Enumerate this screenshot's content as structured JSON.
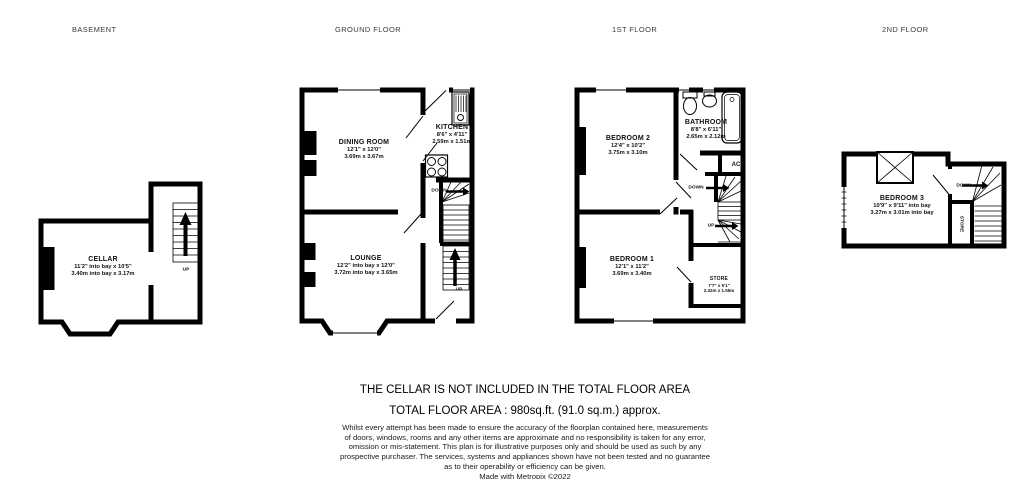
{
  "floors": {
    "basement": {
      "title": "BASEMENT",
      "cellar_name": "CELLAR",
      "cellar_dims": "11'2\" into bay x 10'5\"",
      "cellar_metric": "3.40m into bay x 3.17m",
      "up": "UP"
    },
    "ground": {
      "title": "GROUND FLOOR",
      "dining_name": "DINING ROOM",
      "dining_dims": "12'1\" x 12'0\"",
      "dining_metric": "3.69m x 3.67m",
      "kitchen_name": "KITCHEN",
      "kitchen_dims": "8'6\" x 4'11\"",
      "kitchen_metric": "2.59m x 1.51m",
      "lounge_name": "LOUNGE",
      "lounge_dims": "12'2\" into bay x 12'0\"",
      "lounge_metric": "3.72m into bay x 3.65m",
      "up": "UP",
      "down": "DOWN"
    },
    "first": {
      "title": "1ST FLOOR",
      "bedroom2_name": "BEDROOM 2",
      "bedroom2_dims": "12'4\" x 10'2\"",
      "bedroom2_metric": "3.75m x 3.10m",
      "bathroom_name": "BATHROOM",
      "bathroom_dims": "8'8\" x 6'11\"",
      "bathroom_metric": "2.65m x 2.12m",
      "bedroom1_name": "BEDROOM 1",
      "bedroom1_dims": "12'1\" x 11'2\"",
      "bedroom1_metric": "3.69m x 3.40m",
      "store_name": "STORE",
      "store_dims": "7'7\" x 5'1\"",
      "store_metric": "2.32m x 1.55m",
      "ac": "AC",
      "up": "UP",
      "down": "DOWN"
    },
    "second": {
      "title": "2ND FLOOR",
      "bedroom3_name": "BEDROOM 3",
      "bedroom3_dims": "10'9\" x 9'11\" into bay",
      "bedroom3_metric": "3.27m x 3.01m into bay",
      "store": "STORE",
      "down": "DOWN"
    }
  },
  "footer": {
    "cellar_note": "THE CELLAR IS NOT INCLUDED IN THE TOTAL FLOOR AREA",
    "total_area": "TOTAL FLOOR AREA : 980sq.ft. (91.0 sq.m.) approx.",
    "disclaimer_lines": [
      "Whilst every attempt has been made to ensure the accuracy of the floorplan contained here, measurements",
      "of doors, windows, rooms and any other items are approximate and no responsibility is taken for any error,",
      "omission or mis-statement. This plan is for illustrative purposes only and should be used as such by any",
      "prospective purchaser. The services, systems and appliances shown have not been tested and no guarantee",
      "as to their operability or efficiency can be given."
    ],
    "credit": "Made with Metropix ©2022"
  },
  "colors": {
    "wall": "#000000",
    "text": "#111111",
    "title": "#3c3c3c"
  }
}
